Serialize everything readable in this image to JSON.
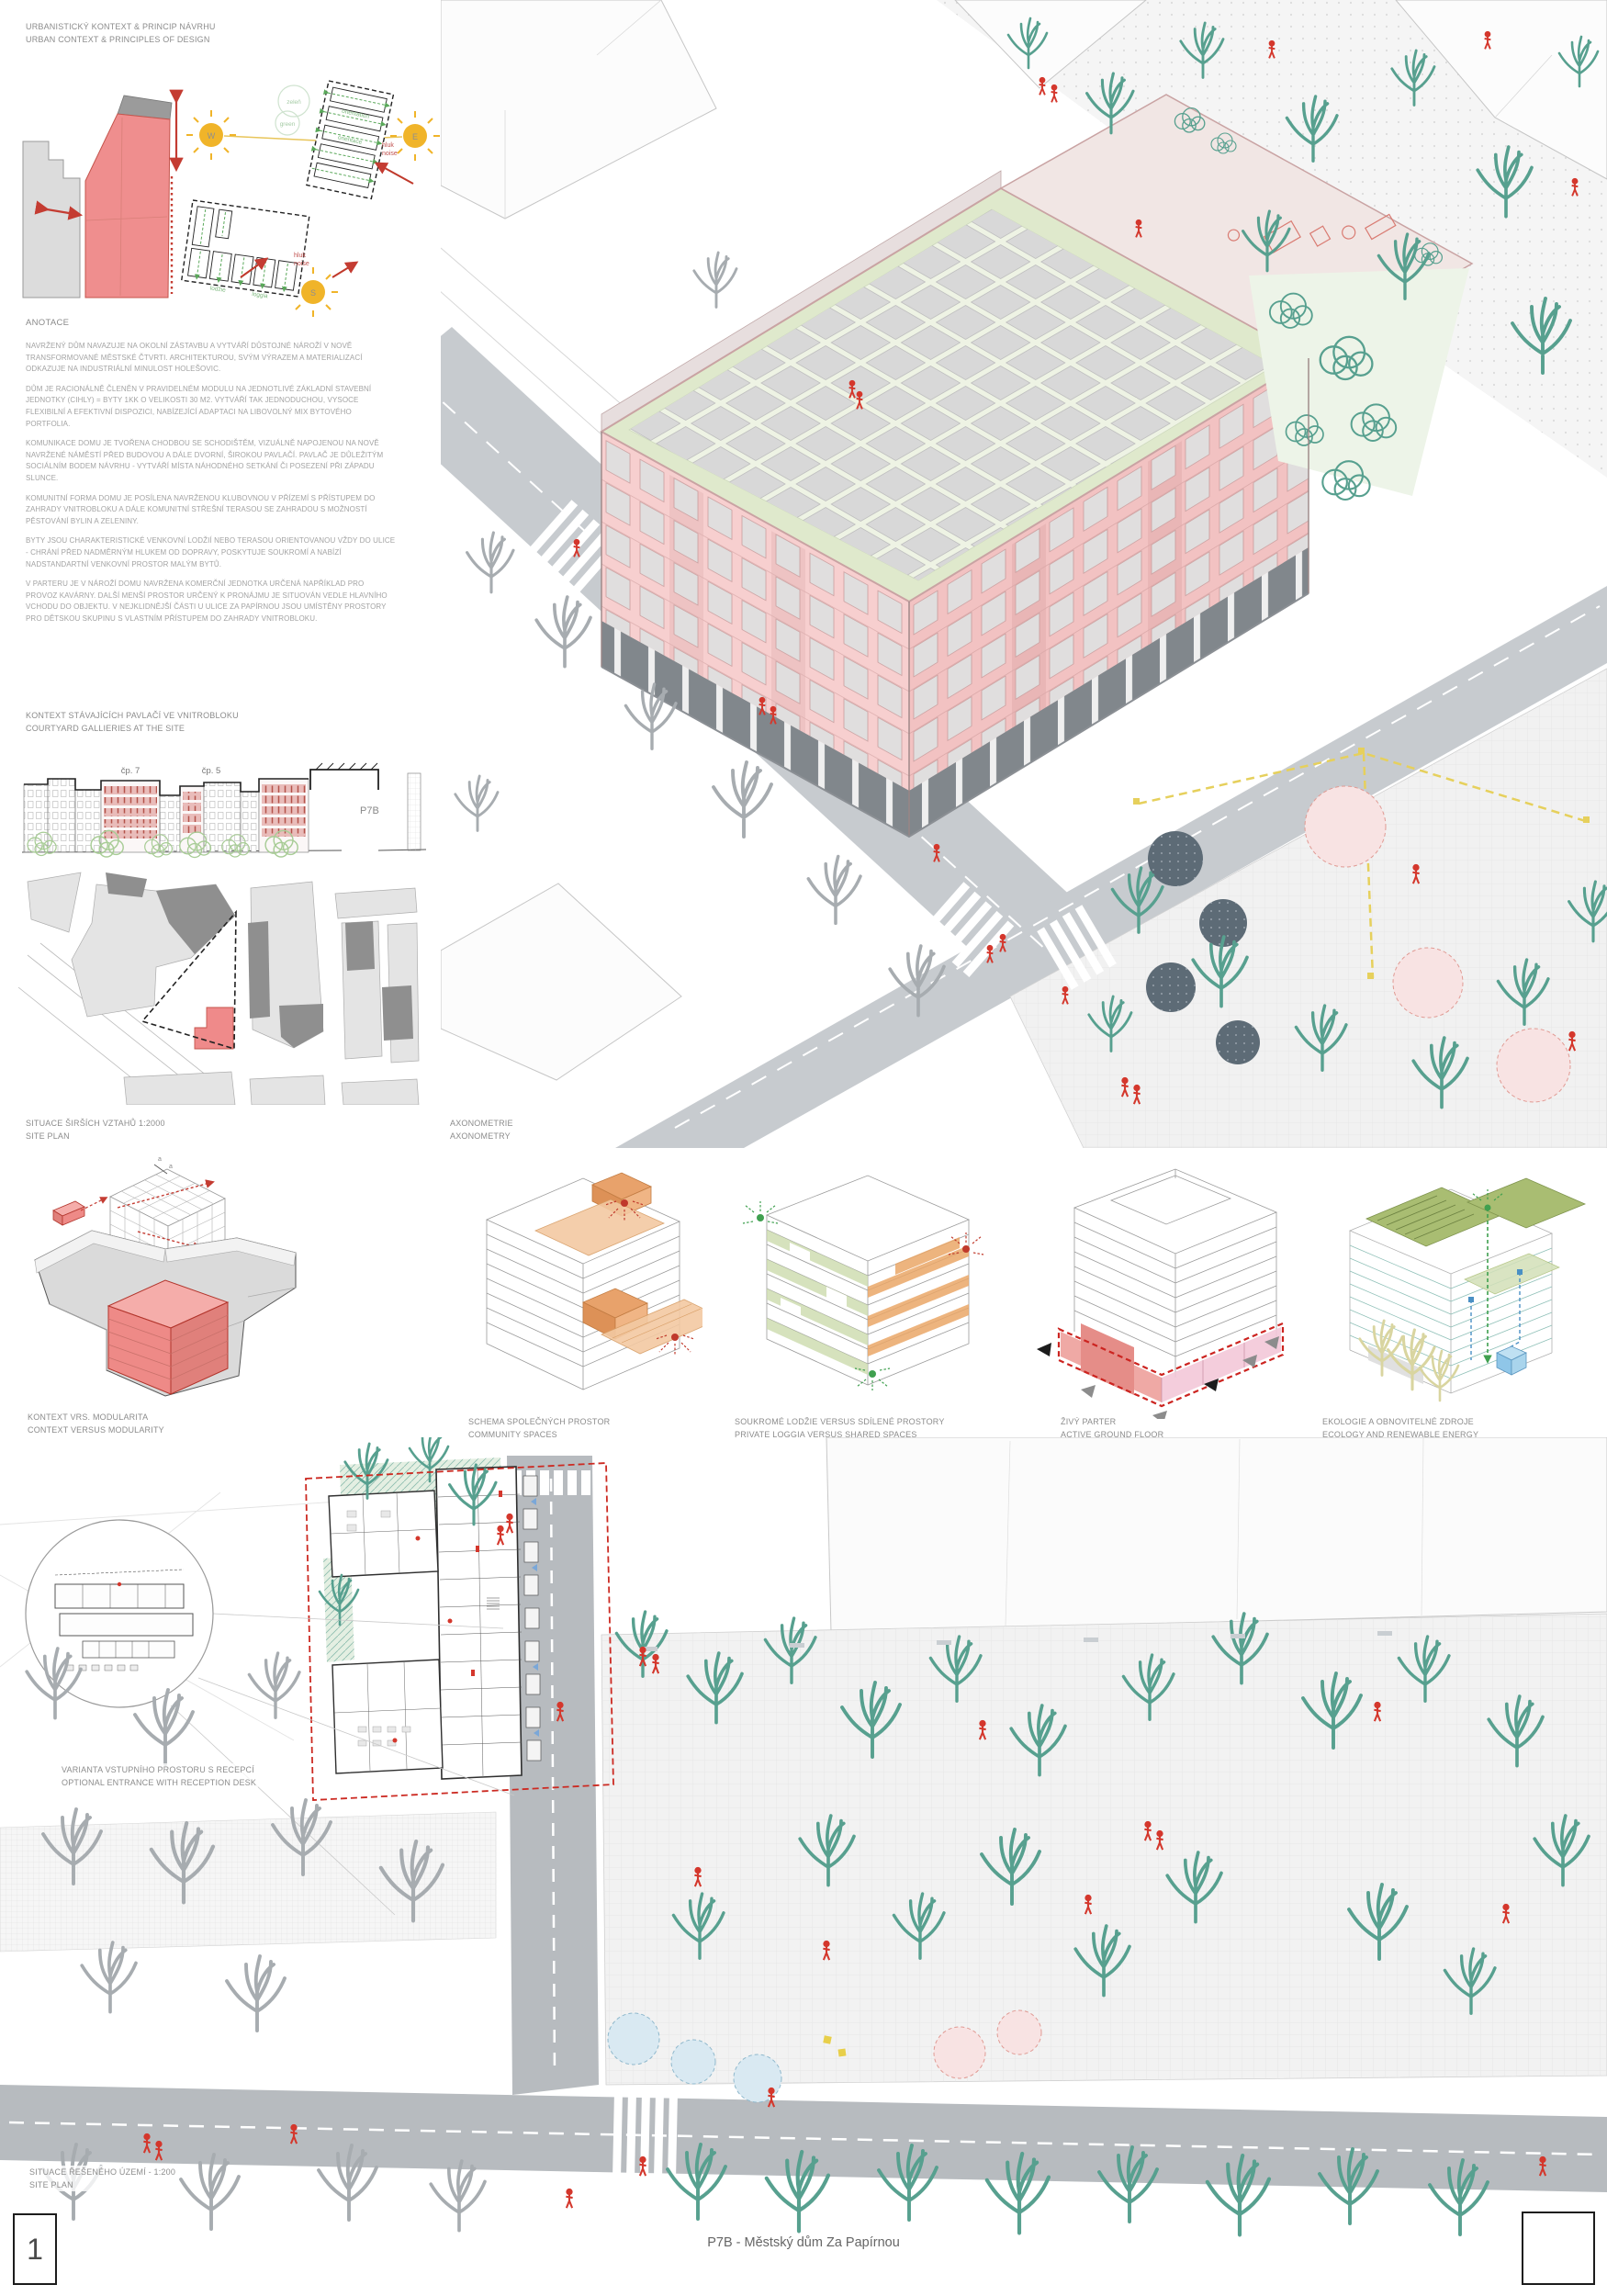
{
  "header": {
    "title_cs": "URBANISTICKÝ KONTEXT & PRINCIP NÁVRHU",
    "title_en": "URBAN CONTEXT & PRINCIPLES OF DESIGN"
  },
  "annotation": {
    "heading": "ANOTACE",
    "paragraphs": [
      "NAVRŽENÝ DŮM NAVAZUJE NA OKOLNÍ ZÁSTAVBU A VYTVÁŘÍ DŮSTOJNÉ NÁROŽÍ V NOVĚ TRANSFORMOVANÉ MĚSTSKÉ ČTVRTI. ARCHITEKTUROU, SVÝM VÝRAZEM A MATERIALIZACÍ ODKAZUJE NA INDUSTRIÁLNÍ MINULOST HOLEŠOVIC.",
      "DŮM JE RACIONÁLNĚ ČLENĚN V PRAVIDELNÉM MODULU NA JEDNOTLIVÉ ZÁKLADNÍ STAVEBNÍ JEDNOTKY (CIHLY) = BYTY 1KK O VELIKOSTI 30 M2. VYTVÁŘÍ TAK JEDNODUCHOU, VYSOCE FLEXIBILNÍ A EFEKTIVNÍ DISPOZICI, NABÍZEJÍCÍ ADAPTACI NA LIBOVOLNÝ MIX BYTOVÉHO PORTFOLIA.",
      "KOMUNIKACE DOMU JE TVOŘENA CHODBOU SE SCHODIŠTĚM, VIZUÁLNĚ NAPOJENOU NA NOVĚ NAVRŽENÉ NÁMĚSTÍ PŘED BUDOVOU A DÁLE DVORNÍ, ŠIROKOU PAVLAČÍ. PAVLAČ JE DŮLEŽITÝM SOCIÁLNÍM BODEM NÁVRHU - VYTVÁŘÍ MÍSTA NÁHODNÉHO SETKÁNÍ ČI POSEZENÍ PŘI ZÁPADU SLUNCE.",
      "KOMUNITNÍ FORMA DOMU JE POSÍLENA NAVRŽENOU KLUBOVNOU V PŘÍZEMÍ S PŘÍSTUPEM DO ZAHRADY VNITROBLOKU A DÁLE KOMUNITNÍ STŘEŠNÍ TERASOU SE ZAHRADOU S MOŽNOSTÍ PĚSTOVÁNÍ BYLIN A ZELENINY.",
      "BYTY JSOU CHARAKTERISTICKÉ VENKOVNÍ LODŽIÍ NEBO TERASOU ORIENTOVANOU VŽDY DO ULICE - CHRÁNÍ PŘED NADMĚRNÝM HLUKEM OD DOPRAVY, POSKYTUJE SOUKROMÍ A NABÍZÍ NADSTANDARTNÍ VENKOVNÍ PROSTOR MALÝM BYTŮ.",
      "V PARTERU JE V NÁROŽÍ DOMU NAVRŽENA KOMERČNÍ JEDNOTKA URČENÁ NAPŘÍKLAD PRO PROVOZ KAVÁRNY. DALŠÍ MENŠÍ PROSTOR URČENÝ K PRONÁJMU JE SITUOVÁN VEDLE HLAVNÍHO VCHODU DO OBJEKTU. V NEJKLIDNĚJŠÍ ČÁSTI U ULICE ZA PAPÍRNOU JSOU UMÍSTĚNY PROSTORY PRO DĚTSKOU SKUPINU S VLASTNÍM PŘÍSTUPEM DO ZAHRADY VNITROBLOKU."
    ]
  },
  "sun": {
    "w": "W",
    "e": "E",
    "s": "S",
    "zelen": "zeleň",
    "green": "green",
    "orientation_en": "orientation",
    "orientation_cs": "orientace",
    "hluk": "hluk",
    "noise": "noise",
    "lodzie": "lodžie",
    "loggia": "loggia"
  },
  "courtyard": {
    "title_cs": "KONTEXT STÁVAJÍCÍCH PAVLAČÍ VE VNITROBLOKU",
    "title_en": "COURTYARD GALLIERIES AT THE SITE",
    "label_cp7": "čp. 7",
    "label_cp5": "čp. 5",
    "label_p7b": "P7B"
  },
  "siteplan2000": {
    "title_cs": "SITUACE ŠIRŠÍCH VZTAHŮ 1:2000",
    "title_en": "SITE PLAN"
  },
  "axonometry": {
    "title_cs": "AXONOMETRIE",
    "title_en": "AXONOMETRY"
  },
  "modularity": {
    "dim_a": "a",
    "dim_b": "b"
  },
  "diagrams": [
    {
      "title_cs": "KONTEXT VRS. MODULARITA",
      "title_en": "CONTEXT VERSUS MODULARITY"
    },
    {
      "title_cs": "SCHEMA SPOLEČNÝCH PROSTOR",
      "title_en": "COMMUNITY SPACES"
    },
    {
      "title_cs": "SOUKROMÉ LODŽIE VERSUS SDÍLENÉ PROSTORY",
      "title_en": "PRIVATE LOGGIA VERSUS SHARED SPACES"
    },
    {
      "title_cs": "ŽIVÝ PARTER",
      "title_en": "ACTIVE GROUND FLOOR"
    },
    {
      "title_cs": "EKOLOGIE A OBNOVITELNÉ ZDROJE",
      "title_en": "ECOLOGY AND RENEWABLE ENERGY"
    }
  ],
  "entrance": {
    "title_cs": "VARIANTA VSTUPNÍHO PROSTORU S RECEPCÍ",
    "title_en": "OPTIONAL ENTRANCE WITH RECEPTION DESK"
  },
  "siteplan200": {
    "title_cs": "SITUACE ŘEŠENÉHO ÚZEMÍ - 1:200",
    "title_en": "SITE PLAN"
  },
  "footer": {
    "page_number": "1",
    "project_title": "P7B - Městský dům Za Papírnou"
  },
  "colors": {
    "accent_red": "#d4372c",
    "building_pink": "#ef8e8e",
    "facade_pink": "#f6cdcd",
    "sun_yellow": "#f0b429",
    "green": "#6db36d",
    "olive": "#a9bd72",
    "teal": "#57a08f",
    "orange": "#eaa768",
    "road_gray": "#c7cbcf"
  }
}
